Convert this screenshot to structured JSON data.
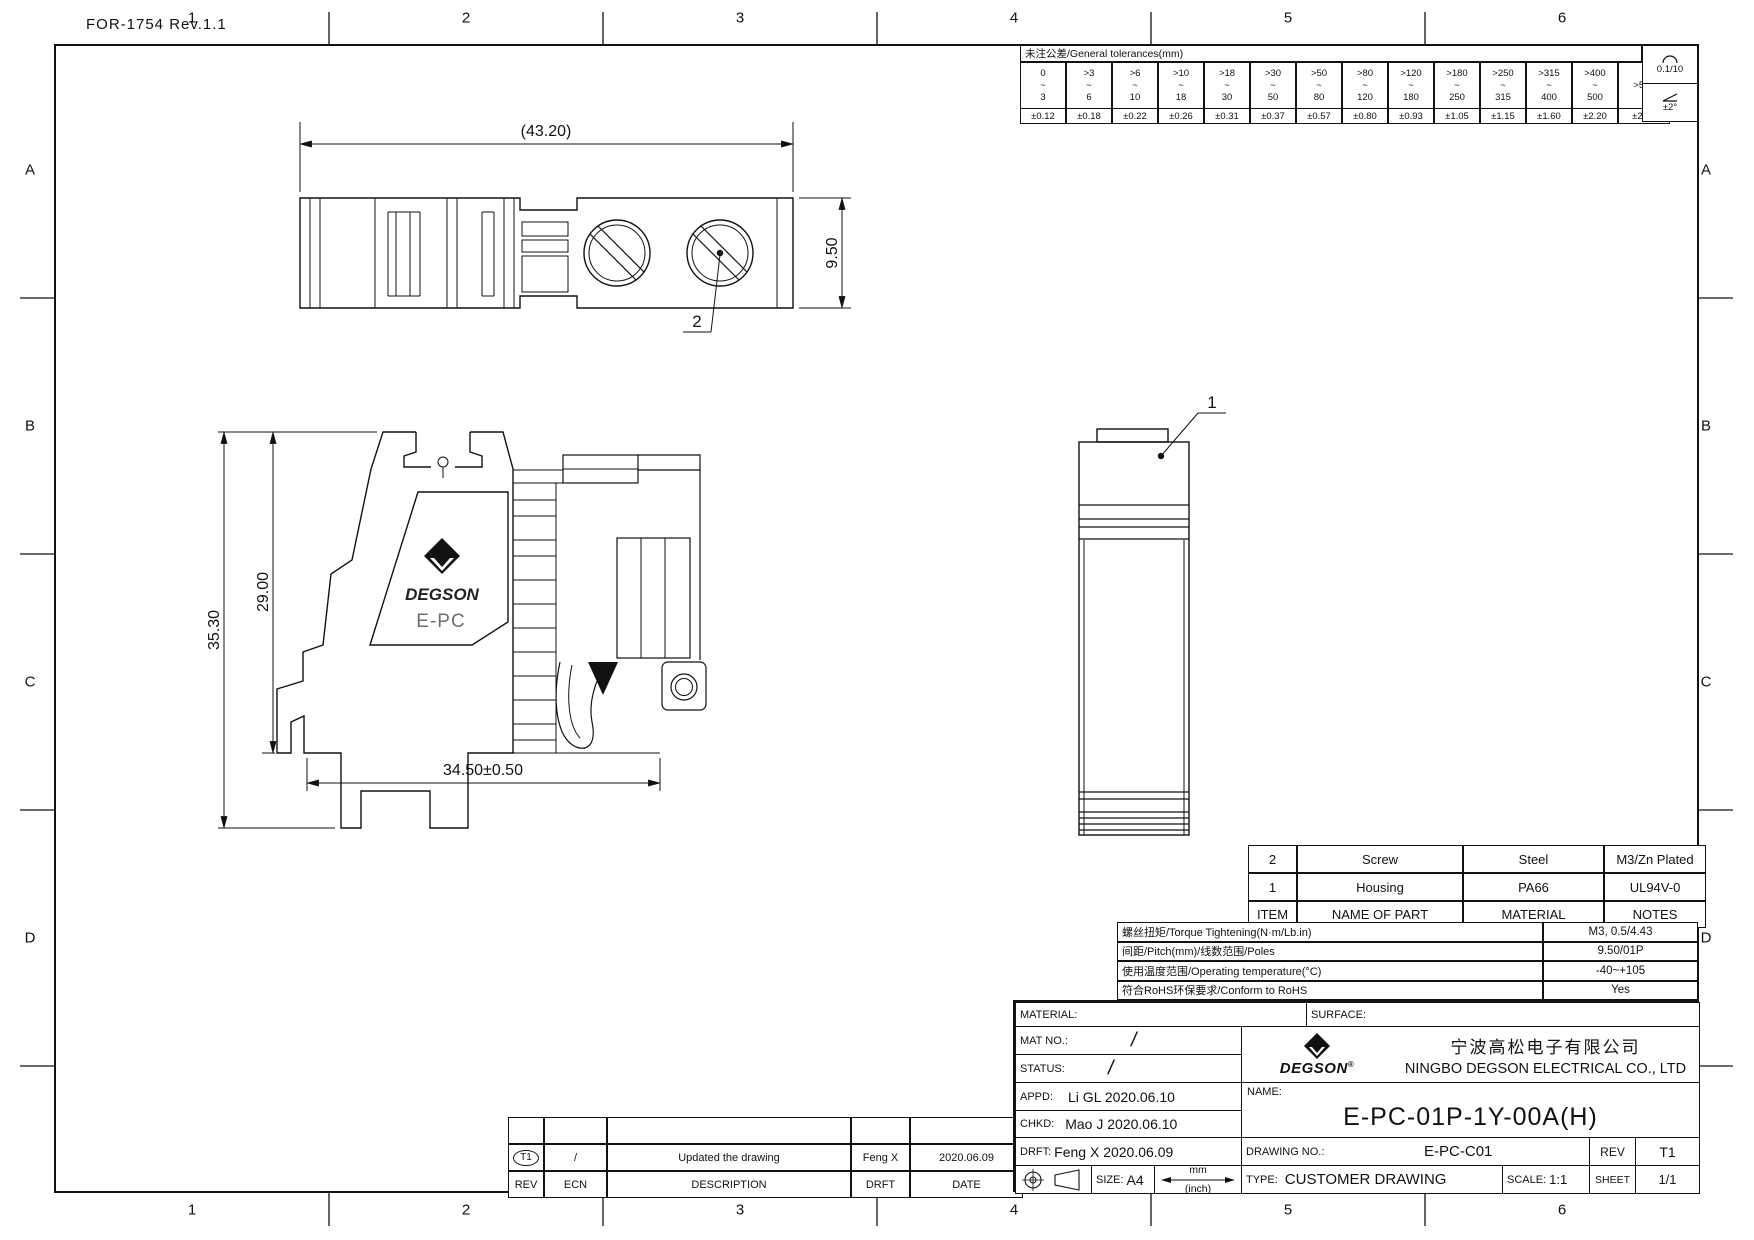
{
  "sheet": {
    "form_ref": "FOR-1754 Rev.1.1",
    "zone_cols": [
      "1",
      "2",
      "3",
      "4",
      "5",
      "6"
    ],
    "zone_rows": [
      "A",
      "B",
      "C",
      "D"
    ]
  },
  "tolerances": {
    "title": "未注公差/General tolerances(mm)",
    "ranges": [
      [
        "0",
        "3"
      ],
      [
        ">3",
        "6"
      ],
      [
        ">6",
        "10"
      ],
      [
        ">10",
        "18"
      ],
      [
        ">18",
        "30"
      ],
      [
        ">30",
        "50"
      ],
      [
        ">50",
        "80"
      ],
      [
        ">80",
        "120"
      ],
      [
        ">120",
        "180"
      ],
      [
        ">180",
        "250"
      ],
      [
        ">250",
        "315"
      ],
      [
        ">315",
        "400"
      ],
      [
        ">400",
        "500"
      ],
      [
        ">500",
        ""
      ]
    ],
    "values": [
      "±0.12",
      "±0.18",
      "±0.22",
      "±0.26",
      "±0.31",
      "±0.37",
      "±0.57",
      "±0.80",
      "±0.93",
      "±1.05",
      "±1.15",
      "±1.60",
      "±2.20",
      "±2.50"
    ],
    "flatness": "0.1/10",
    "angle": "±2°"
  },
  "views": {
    "dims": {
      "overall_width": "(43.20)",
      "end_height": "9.50",
      "total_height": "35.30",
      "body_height": "29.00",
      "bottom_length": "34.50±0.50"
    },
    "callouts": {
      "housing": "1",
      "screw": "2"
    },
    "brand": "DEGSON",
    "series": "E-PC"
  },
  "parts_table": {
    "headers": [
      "ITEM",
      "NAME OF PART",
      "MATERIAL",
      "NOTES"
    ],
    "rows": [
      [
        "2",
        "Screw",
        "Steel",
        "M3/Zn Plated"
      ],
      [
        "1",
        "Housing",
        "PA66",
        "UL94V-0"
      ]
    ]
  },
  "specs": [
    {
      "label": "螺丝扭矩/Torque Tightening(N·m/Lb.in)",
      "value": "M3, 0.5/4.43"
    },
    {
      "label": "间距/Pitch(mm)/线数范围/Poles",
      "value": "9.50/01P"
    },
    {
      "label": "使用温度范围/Operating temperature(°C)",
      "value": "-40~+105"
    },
    {
      "label": "符合RoHS环保要求/Conform to RoHS",
      "value": "Yes"
    }
  ],
  "revision_table": {
    "headers": [
      "REV",
      "ECN",
      "DESCRIPTION",
      "DRFT",
      "DATE"
    ],
    "rows": [
      [
        "T1",
        "/",
        "Updated the drawing",
        "Feng X",
        "2020.06.09"
      ]
    ]
  },
  "title_block": {
    "material_label": "MATERIAL:",
    "surface_label": "SURFACE:",
    "mat_no_label": "MAT NO.:",
    "mat_no_value": "/",
    "status_label": "STATUS:",
    "status_value": "/",
    "appd_label": "APPD:",
    "appd_value": "Li GL 2020.06.10",
    "chkd_label": "CHKD:",
    "chkd_value": "Mao J 2020.06.10",
    "drft_label": "DRFT:",
    "drft_value": "Feng X 2020.06.09",
    "size_label": "SIZE:",
    "size_value": "A4",
    "units_top": "mm",
    "units_bottom": "(inch)",
    "brand": "DEGSON",
    "brand_reg": "®",
    "company_cn": "宁波高松电子有限公司",
    "company_en": "NINGBO DEGSON ELECTRICAL CO., LTD",
    "name_label": "NAME:",
    "part_name": "E-PC-01P-1Y-00A(H)",
    "drawing_no_label": "DRAWING NO.:",
    "drawing_no": "E-PC-C01",
    "rev_label": "REV",
    "rev_value": "T1",
    "type_label": "TYPE:",
    "type_value": "CUSTOMER DRAWING",
    "scale_label": "SCALE:",
    "scale_value": "1:1",
    "sheet_label": "SHEET",
    "sheet_value": "1/1"
  }
}
